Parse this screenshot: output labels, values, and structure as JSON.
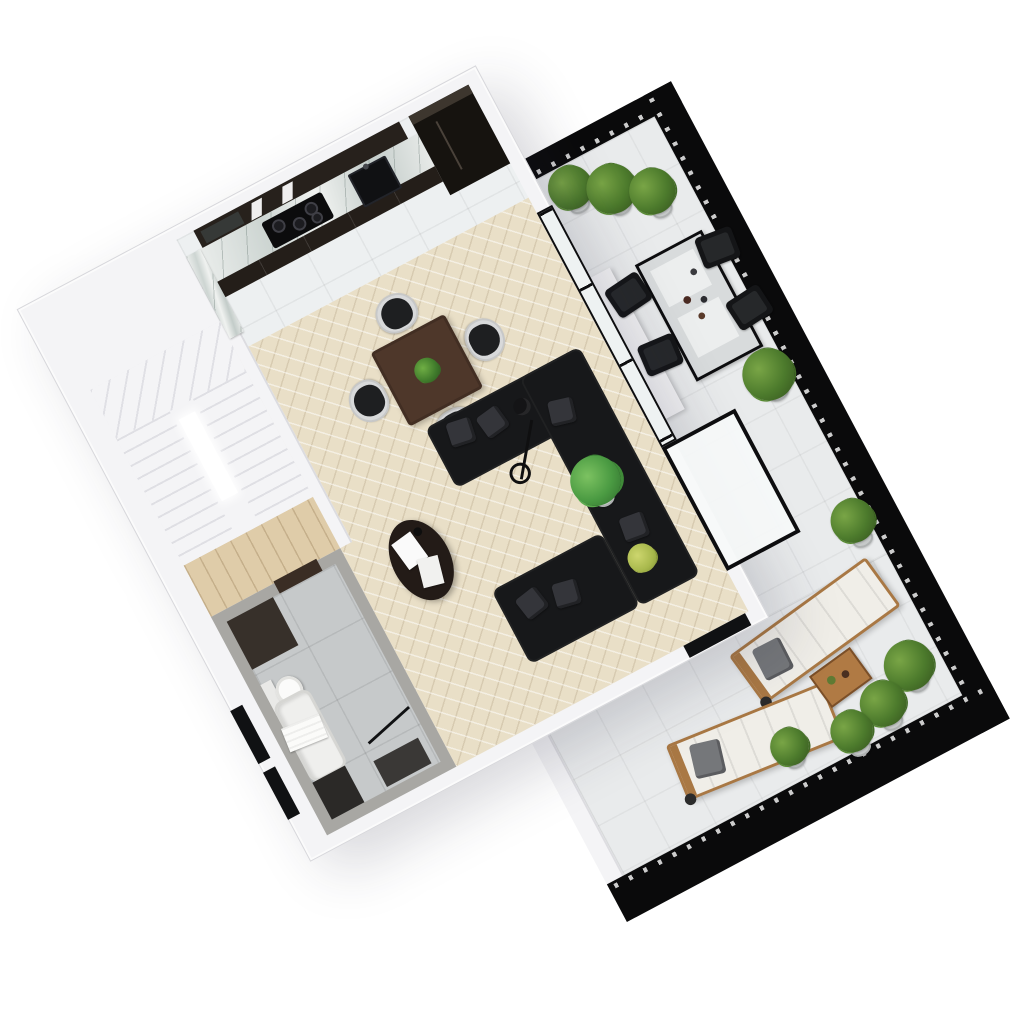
{
  "scene": {
    "type": "3d-isometric-floor-plan-render",
    "subject": "apartment-with-large-terrace",
    "plan_rotation_deg": -28,
    "rooms": [
      "kitchen",
      "living-dining-room",
      "staircase",
      "hallway",
      "bathroom",
      "terrace"
    ]
  },
  "inventory": {
    "kitchen": [
      "upper-cabinets",
      "marble-countertop",
      "induction-cooktop",
      "sink",
      "tall-cabinet-column"
    ],
    "living_dining": [
      "square-dining-table",
      "dining-chairs",
      "plant-centerpiece",
      "l-shaped-sofa",
      "throw-pillows",
      "oval-coffee-table",
      "magazines",
      "floor-lamp",
      "monstera-plant",
      "fern-plant"
    ],
    "bathroom": [
      "dark-accent-panel",
      "toilet",
      "bathtub",
      "towel",
      "shower-glass-door",
      "shower-tray",
      "bath-mat",
      "dark-doorway"
    ],
    "staircase": [
      "u-shaped-stair",
      "winder-treads",
      "stairwell-void"
    ],
    "terrace": [
      "black-slatted-railing",
      "potted-shrubs",
      "outdoor-dining-table",
      "outdoor-chairs",
      "tableware",
      "white-planter-box",
      "sun-loungers",
      "lounger-pillows",
      "wooden-side-table",
      "corner-glass-bay",
      "white-side-wall"
    ]
  },
  "counts": {
    "dining_chairs": 4,
    "outdoor_chairs": 4,
    "sun_loungers": 2,
    "potted_shrubs": 9,
    "throw_pillows": 7,
    "magazines": 2,
    "cooktop_burners": 4
  },
  "colors": {
    "background": "#ffffff",
    "wall": "#f4f4f6",
    "wall_edge": "#d7d7db",
    "herringbone": "#e9dfc7",
    "kitchen_tile": "#edf0f1",
    "terrace_tile": "#e9ebec",
    "bath_tile": "#c6c9ca",
    "bath_wall": "#a8a7a3",
    "bath_accent": "#37302a",
    "stair": "#f4f4f6",
    "sofa": "#17181a",
    "pillow": "#34353a",
    "dining_table": "#4e372a",
    "chair_shell": "#d8d9da",
    "chair_seat": "#1e1f21",
    "coffee_table": "#231b17",
    "black_frame": "#0d0d0f",
    "railing": "#0a0a0b",
    "cabinet_dark": "#241e19",
    "upper_cabinet": "#27211c",
    "column_black": "#16130f",
    "plant_green": "#4c7a2c",
    "plant_light": "#79a546",
    "plant_dark": "#33511d",
    "fern": "#a8b84c",
    "wood_floor": "#dfcca9",
    "lounger_wood": "#a97844",
    "lounger_cushion": "#f0eee8",
    "lounger_pillow": "#75777a",
    "outdoor_top": "#d8dbdc",
    "pot": "#c6c9c9",
    "towel": "#fbfbf9",
    "glass": "#eef2f2"
  }
}
